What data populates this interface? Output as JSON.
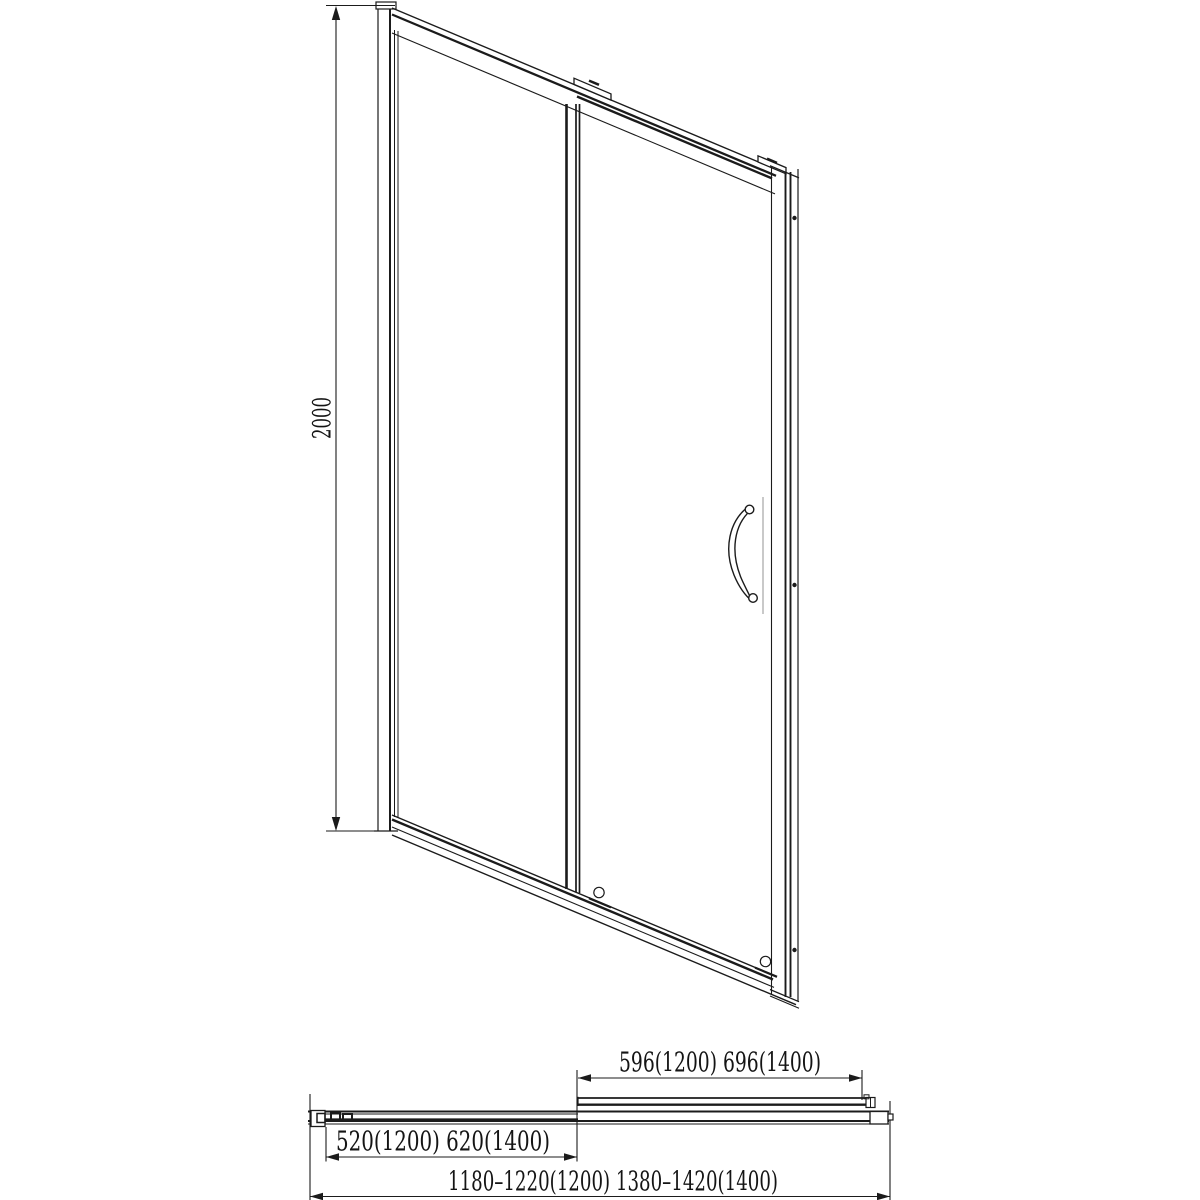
{
  "colors": {
    "line": "#1b1b1b",
    "background": "#ffffff",
    "glass_highlight": "#c9c9c9"
  },
  "front_view": {
    "height_dimension_label": "2000"
  },
  "plan_view": {
    "sliding_panel_dimension_label": "596(1200) 696(1400)",
    "fixed_panel_dimension_label": "520(1200) 620(1400)",
    "overall_width_dimension_label": "1180–1220(1200) 1380–1420(1400)"
  }
}
